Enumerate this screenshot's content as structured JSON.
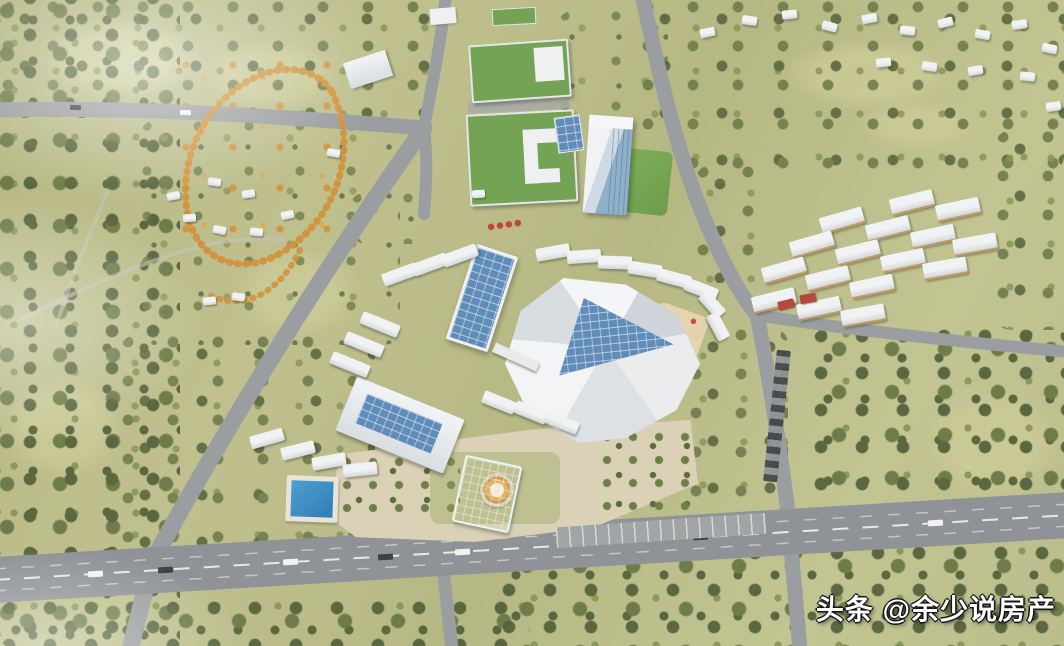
{
  "watermark": {
    "text": "头条 @余少说房产"
  },
  "palette": {
    "grass_base": "#b6b884",
    "grass_light": "#cbcb97",
    "forest_dark": "#55633c",
    "forest_mid": "#6a7947",
    "tree_light": "#8a9659",
    "autumn_orange": "#d2923c",
    "road_gray": "#9b9ea0",
    "road_light": "#c6c5bc",
    "highway_gray": "#8f9296",
    "lane_white": "#f2f2ec",
    "plaza_beige": "#dbd1b7",
    "building_white": "#f1f2f3",
    "building_gray": "#d3d8dc",
    "glass_blue": "#5f8cb8",
    "green_roof": "#74a355",
    "lawn_green": "#7fae5a",
    "teal_glass": "#3f9fa3",
    "pool_blue": "#2f7db8",
    "accent_red": "#bf4639",
    "car_dark": "#3d4247",
    "watermark_white": "#ffffff",
    "watermark_outline": "#141414"
  }
}
